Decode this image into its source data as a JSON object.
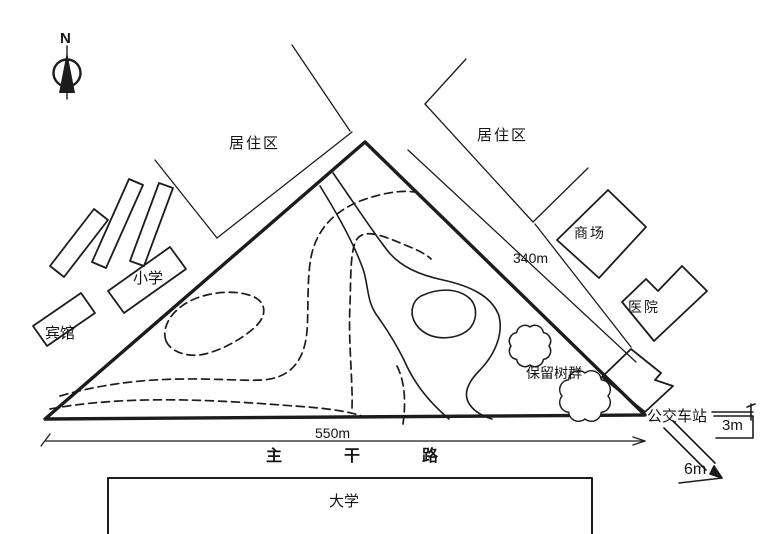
{
  "compass": {
    "north_label": "N"
  },
  "areas": {
    "residential_left": "居住区",
    "residential_right": "居住区",
    "school": "小学",
    "hotel": "宾馆",
    "mall": "商场",
    "hospital": "医院",
    "bus_station": "公交车站",
    "preserved_trees": "保留树群",
    "university": "大学"
  },
  "main_road": {
    "char1": "主",
    "char2": "干",
    "char3": "路"
  },
  "dimensions": {
    "base_length": "550m",
    "east_side_length": "340m",
    "sidewalk_width": "3m",
    "road_width": "6m"
  },
  "colors": {
    "line": "#1c1c1c",
    "background": "#ffffff"
  }
}
